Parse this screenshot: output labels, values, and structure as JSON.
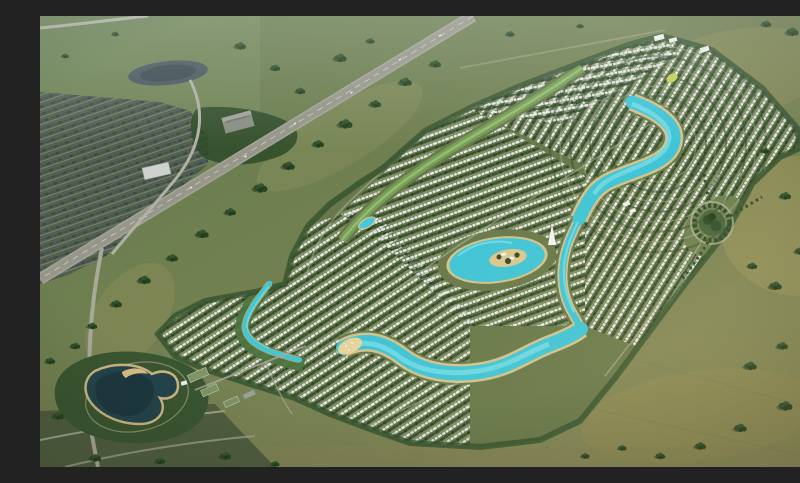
{
  "meta": {
    "type": "aerial-render",
    "title": "Master-planned lagoon community - aerial view",
    "description": "Aerial rendering of a large master-planned villa community: dense curved rows of white villas threaded by a winding turquoise lagoon, a circular lagoon with a sandy island clubhouse, a second long swimming lagoon with beaches, a light-green park spine, a dark lake park with a crescent beach island at the lower left, a tree-ringed roundabout park at the eastern edge, a divided highway with an existing dark-roofed suburb and pond in the upper left, all surrounded by open green and tan farmland dotted with tree clusters.",
    "text_visible": false
  },
  "scene": {
    "features": [
      "open-fields",
      "existing-suburb",
      "suburb-pond",
      "forest-band",
      "highway",
      "highway-ramp",
      "warehouse-building",
      "grain-silos",
      "development-site",
      "villa-rows",
      "green-spine-park",
      "spine-pool",
      "winding-lagoon",
      "lagoon-channel",
      "central-lagoon",
      "island-clubhouse",
      "lower-lagoon",
      "lagoon-beach",
      "west-park-waterway",
      "roundabout-park",
      "lake-park",
      "lake-island",
      "park-buildings",
      "tree-clusters",
      "ne-commercial-buildings",
      "sail-landmark"
    ]
  },
  "palette": {
    "field_green": "#6e7c4e",
    "field_tan": "#a59a60",
    "site_green": "#68784a",
    "park_green": "#79a558",
    "tree_dark": "#2e4b2a",
    "lagoon": "#3fc4d7",
    "lagoon_light": "#8fe7ec",
    "beach_sand": "#e3d098",
    "villa_white": "#e9ebe6",
    "road_gray": "#a3a396",
    "suburb_roof": "#49525c",
    "lake_dark": "#24434b",
    "building_white": "#f1f2ee"
  }
}
